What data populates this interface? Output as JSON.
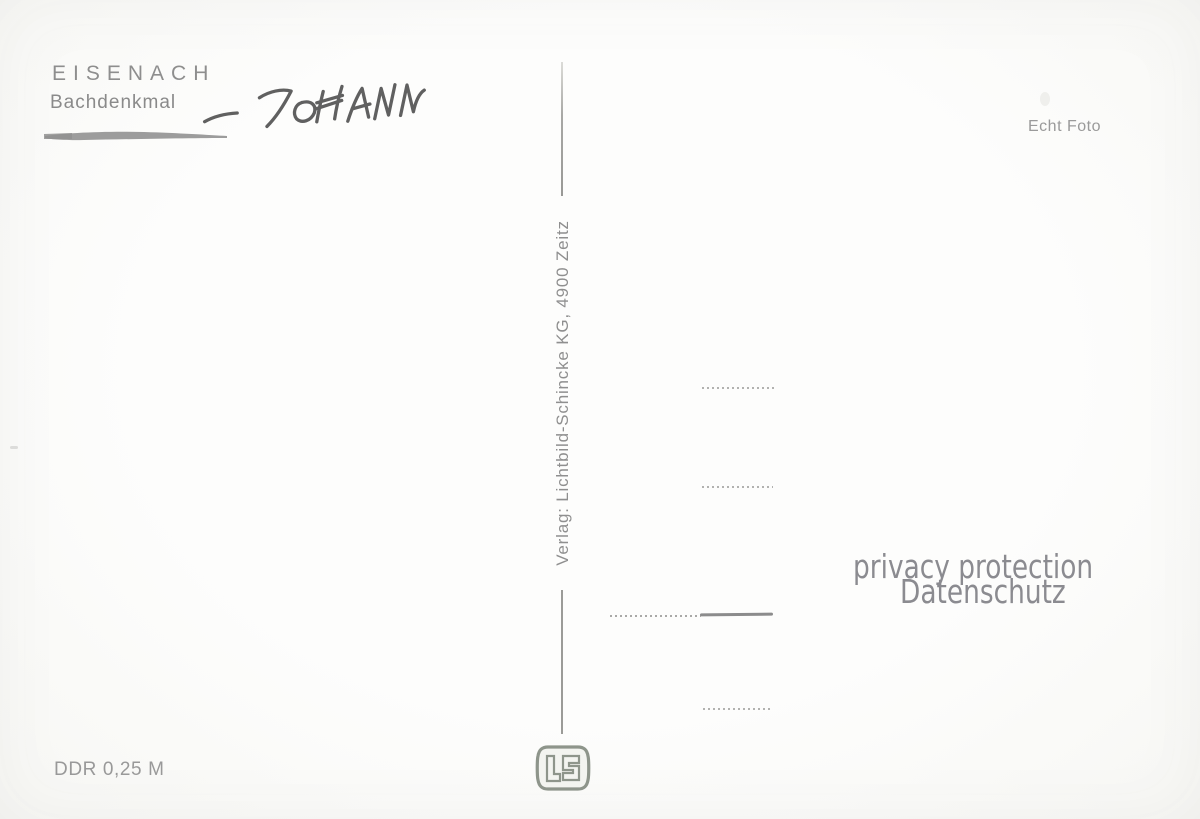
{
  "postcard": {
    "title": "EISENACH",
    "subtitle": "Bachdenkmal",
    "handwritten_note": "JOHANN",
    "photo_type_label": "Echt Foto",
    "publisher_imprint": "Verlag: Lichtbild-Schincke KG, 4900 Zeitz",
    "price_label": "DDR 0,25 M",
    "watermark": {
      "line1": "privacy protection",
      "line2": "Datenschutz"
    },
    "publisher_logo": "LS monogram emblem (Lichtbild-Schincke)",
    "address_ruling": {
      "dotted_line_count": 4,
      "third_line_has_solid_segment": true
    },
    "colors": {
      "background": "#fcfcfb",
      "print_gray": "#8f8f8f",
      "handwriting_ink": "#4b4b4b",
      "watermark_gray": "#8b8b90",
      "dotted_line": "#b2b2b0",
      "solid_line": "#8c8c8c",
      "logo_gray_green": "#8e958b"
    }
  }
}
